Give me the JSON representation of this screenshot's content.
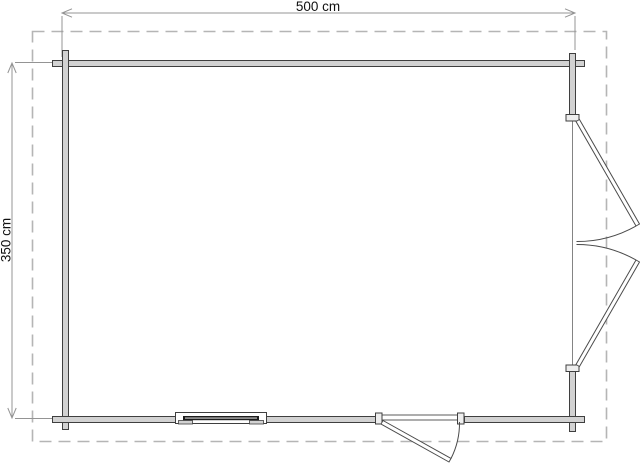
{
  "plan": {
    "title": "floor plan",
    "dimensions": {
      "width_label": "500 cm",
      "height_label": "350 cm"
    },
    "colors": {
      "background": "#ffffff",
      "wall_fill": "#d2d2d2",
      "wall_stroke": "#3f3f3f",
      "door_stroke": "#4a4a4a",
      "dimension_line": "#949494",
      "dashed_outline": "#b5b5b5",
      "label_text": "#111111",
      "window_glass": "#1c1c1c"
    }
  }
}
